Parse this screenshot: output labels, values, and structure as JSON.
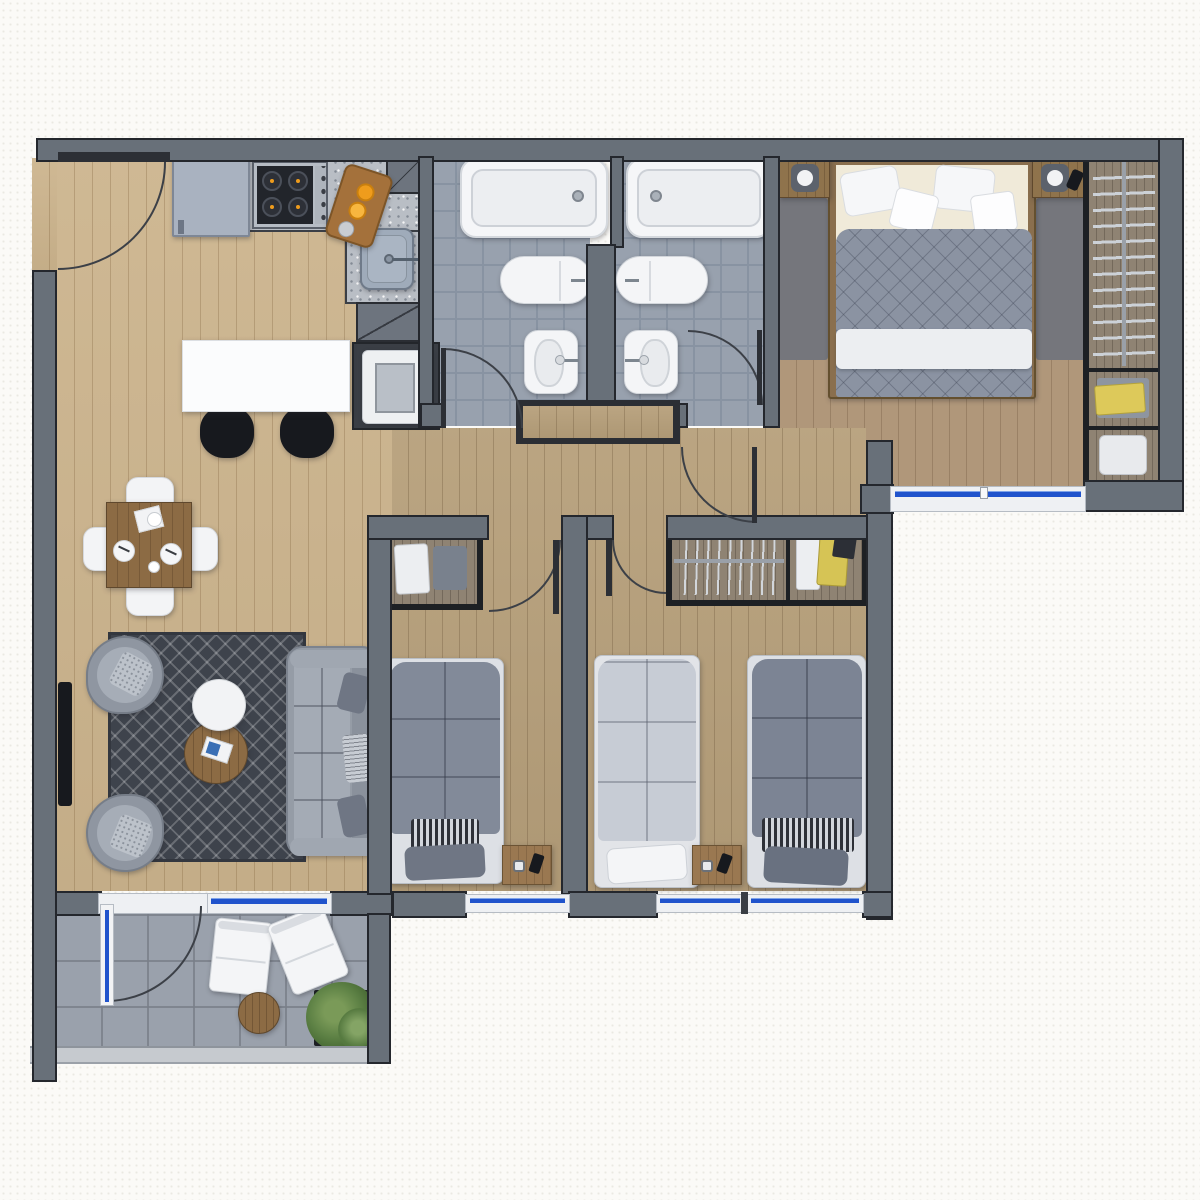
{
  "palette": {
    "wall_fill": "#687079",
    "wall_edge": "#24272d",
    "wood_light": "#ccb48d",
    "wood_mid": "#b7a07b",
    "wood_master": "#b0977a",
    "wood_closet": "#8f8373",
    "wood_furniture": "#8c6b44",
    "tile_bath": "#98a1ae",
    "tile_grout": "#8893a2",
    "balcony_tile": "#9aa1ac",
    "terrazzo": "#b9bec5",
    "rug_dark": "#3e434c",
    "duvet_gray": "#8b93a2",
    "duvet_light": "#c7ccd5",
    "fabric_gray": "#959ca6",
    "fabric_dark": "#6f7684",
    "white": "#f3f4f6",
    "window_blue": "#2053cc",
    "arc_color": "#3c4047",
    "accent_orange": "#ef9c1c",
    "plant_green": "#567c42",
    "appliance_black": "#17191e"
  },
  "plan": {
    "rooms": [
      {
        "id": "kitchen",
        "fixtures": [
          "refrigerator",
          "cooktop-4-burners",
          "terrazzo-counter",
          "kitchen-sink",
          "cutting-board",
          "island-counter",
          "bar-stool",
          "bar-stool",
          "washing-machine",
          "upper-cabinet",
          "lower-cabinet"
        ]
      },
      {
        "id": "living-dining",
        "fixtures": [
          "dining-table",
          "dining-chair",
          "dining-chair",
          "dining-chair",
          "dining-chair",
          "geometric-rug",
          "sofa",
          "armchair",
          "armchair",
          "round-coffee-table",
          "round-side-table",
          "tv",
          "magazine"
        ]
      },
      {
        "id": "bathroom-1",
        "fixtures": [
          "bathtub",
          "vanity-basin",
          "toilet"
        ]
      },
      {
        "id": "bathroom-2",
        "fixtures": [
          "bathtub",
          "vanity-basin",
          "toilet"
        ]
      },
      {
        "id": "master-bedroom",
        "fixtures": [
          "double-bed",
          "nightstand-lamp",
          "nightstand-lamp",
          "phone",
          "side-rug",
          "side-rug",
          "wardrobe-hangers",
          "wardrobe-shelf-clothes",
          "wardrobe-shelf-towels"
        ]
      },
      {
        "id": "bedroom-2",
        "fixtures": [
          "single-bed",
          "open-wardrobe-clothes",
          "desk",
          "phone"
        ]
      },
      {
        "id": "bedroom-3",
        "fixtures": [
          "single-bed",
          "single-bed",
          "closet-hangers",
          "closet-shelf-clothes",
          "desk",
          "phone"
        ]
      },
      {
        "id": "balcony",
        "fixtures": [
          "lounge-chair",
          "lounge-chair",
          "round-table",
          "potted-plant",
          "railing"
        ]
      }
    ],
    "openings": [
      "entry-door",
      "bathroom-1-door",
      "bathroom-2-door",
      "master-bedroom-door",
      "bedroom-2-door",
      "bedroom-3-door",
      "balcony-sliding-door"
    ],
    "windows": [
      "master-bedroom-window",
      "bedroom-2-window",
      "bedroom-3-window-a",
      "bedroom-3-window-b",
      "balcony-window"
    ]
  }
}
